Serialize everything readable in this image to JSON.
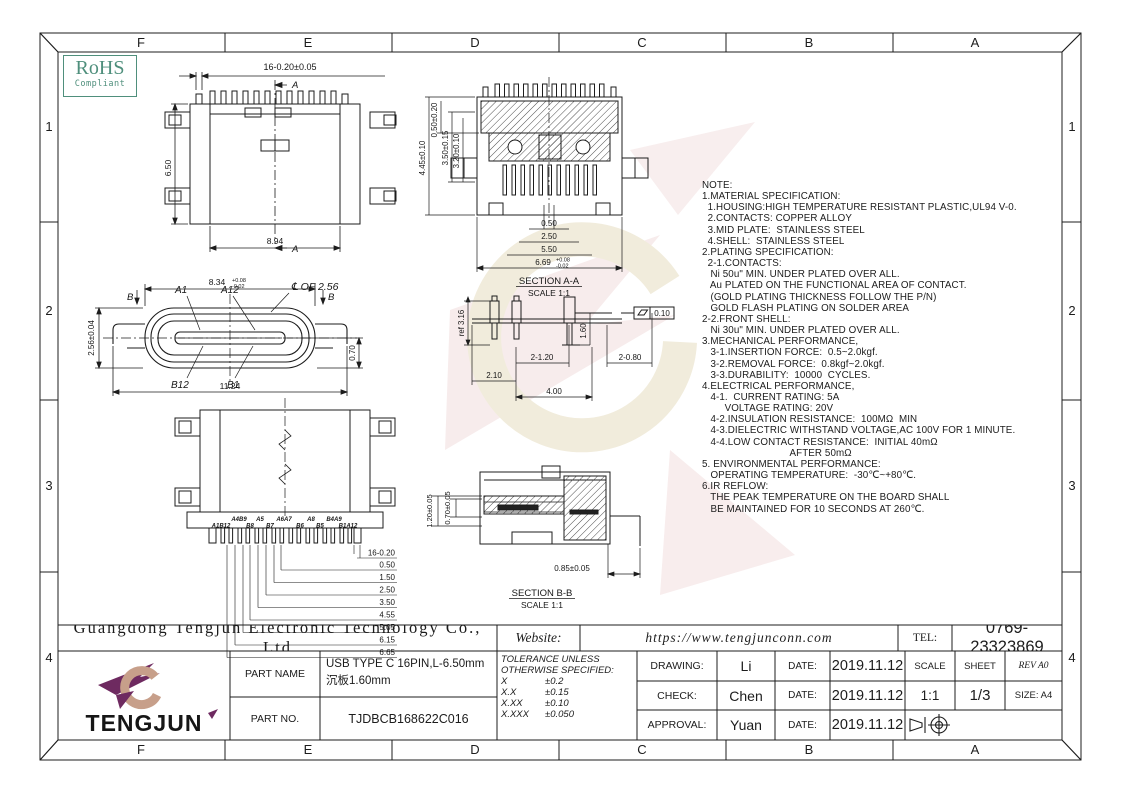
{
  "sheet": {
    "border": {
      "cols": [
        "F",
        "E",
        "D",
        "C",
        "B",
        "A"
      ],
      "rows": [
        "1",
        "2",
        "3",
        "4"
      ]
    },
    "rohs": {
      "line1": "RoHS",
      "line2": "Compliant"
    }
  },
  "views": {
    "top": {
      "dim_pitch": "16-0.20±0.05",
      "section_top": "A",
      "section_bottom": "A",
      "dim_height": "6.50",
      "dim_width": "8.94"
    },
    "front": {
      "dim_top_base": "8.34",
      "dim_top_tol_up": "+0.08",
      "dim_top_tol_dn": "-0.02",
      "pin_a1": "A1",
      "pin_a12": "A12",
      "pin_b12": "B12",
      "pin_b1": "B1",
      "centerline": "℄ OF 2.56",
      "section_left": "B",
      "section_right": "B",
      "dim_left": "2.56±0.04",
      "dim_bottom": "11.24",
      "dim_right": "0.70"
    },
    "section_a": {
      "title": "SECTION A-A",
      "scale": "SCALE 1:1",
      "dims_left": [
        "4.45±0.10",
        "0.50±0.20",
        "3.50±0.15",
        "3.20±0.10"
      ],
      "dims_bottom": [
        "0.50",
        "2.50",
        "5.50"
      ],
      "dim_base": "6.69",
      "tol_up": "+0.08",
      "tol_dn": "-0.02"
    },
    "side": {
      "dim_ref": "ref 3.16",
      "dim_160": "1.60",
      "flatness": "0.10",
      "d1": "2-1.20",
      "d2": "2-0.80",
      "d3": "2.10",
      "d4": "4.00"
    },
    "bottom": {
      "pins_top": [
        "A4B9",
        "A5",
        "A6A7",
        "A8",
        "B4A9"
      ],
      "pins_bottom": [
        "A1B12",
        "B8",
        "B7",
        "B6",
        "B5",
        "B1A12"
      ],
      "dims": [
        "16-0.20",
        "0.50",
        "1.50",
        "2.50",
        "3.50",
        "4.55",
        "5.05",
        "6.15",
        "6.65"
      ]
    },
    "section_b": {
      "title": "SECTION B-B",
      "scale": "SCALE 1:1",
      "d_left1": "1.20±0.05",
      "d_left2": "0.70±0.05",
      "d_bottom": "0.85±0.05"
    }
  },
  "notes": [
    "NOTE:",
    "1.MATERIAL SPECIFICATION:",
    "  1.HOUSING:HIGH TEMPERATURE RESISTANT PLASTIC,UL94 V-0.",
    "  2.CONTACTS: COPPER ALLOY",
    "  3.MID PLATE:  STAINLESS STEEL",
    "  4.SHELL:  STAINLESS STEEL",
    "2.PLATING SPECIFICATION:",
    "  2-1.CONTACTS:",
    "   Ni 50u\" MIN. UNDER PLATED OVER ALL.",
    "   Au PLATED ON THE FUNCTIONAL AREA OF CONTACT.",
    "   (GOLD PLATING THICKNESS FOLLOW THE P/N)",
    "   GOLD FLASH PLATING ON SOLDER AREA",
    "2-2.FRONT SHELL:",
    "   Ni 30u\" MIN. UNDER PLATED OVER ALL.",
    "3.MECHANICAL PERFORMANCE,",
    "   3-1.INSERTION FORCE:  0.5~2.0kgf.",
    "   3-2.REMOVAL FORCE:  0.8kgf~2.0kgf.",
    "   3-3.DURABILITY:  10000  CYCLES.",
    "4.ELECTRICAL PERFORMANCE,",
    "   4-1.  CURRENT RATING: 5A",
    "        VOLTAGE RATING: 20V",
    "   4-2.INSULATION RESISTANCE:  100MΩ  MIN",
    "   4-3.DIELECTRIC WITHSTAND VOLTAGE,AC 100V FOR 1 MINUTE.",
    "   4-4.LOW CONTACT RESISTANCE:  INITIAL 40mΩ",
    "                               AFTER 50mΩ",
    "5. ENVIRONMENTAL PERFORMANCE:",
    "   OPERATING TEMPERATURE:  -30℃~+80℃.",
    "6.IR REFLOW:",
    "   THE PEAK TEMPERATURE ON THE BOARD SHALL",
    "   BE MAINTAINED FOR 10 SECONDS AT 260℃."
  ],
  "title_block": {
    "company": "Guangdong Tengjun Electronic Technology Co., Ltd",
    "logo_text": "TENGJUN",
    "part_name_label": "PART NAME",
    "part_name_line1": "USB TYPE C 16PIN,L-6.50mm",
    "part_name_line2": "沉板1.60mm",
    "part_no_label": "PART NO.",
    "part_no_value": "TJDBCB168622C016",
    "website_label": "Website:",
    "website_value": "https://www.tengjunconn.com",
    "tel_label": "TEL:",
    "tel_value": "0769-23323869",
    "tol": {
      "h1": "TOLERANCE UNLESS",
      "h2": "OTHERWISE SPECIFIED:",
      "rows": [
        [
          "X",
          "±0.2"
        ],
        [
          "X.X",
          "±0.15"
        ],
        [
          "X.XX",
          "±0.10"
        ],
        [
          "X.XXX",
          "±0.050"
        ]
      ]
    },
    "drawing_label": "DRAWING:",
    "drawing_name": "Li",
    "check_label": "CHECK:",
    "check_name": "Chen",
    "approval_label": "APPROVAL:",
    "approval_name": "Yuan",
    "date_label": "DATE:",
    "dates": [
      "2019.11.12",
      "2019.11.12",
      "2019.11.12"
    ],
    "scale_label": "SCALE",
    "sheet_label": "SHEET",
    "rev": "REV A0",
    "scale_value": "1:1",
    "sheet_value": "1/3",
    "size": "SIZE: A4"
  },
  "colors": {
    "accent_green": "#4f8f7c",
    "logo_purple": "#6e2a60",
    "logo_tan": "#c79f8a"
  }
}
